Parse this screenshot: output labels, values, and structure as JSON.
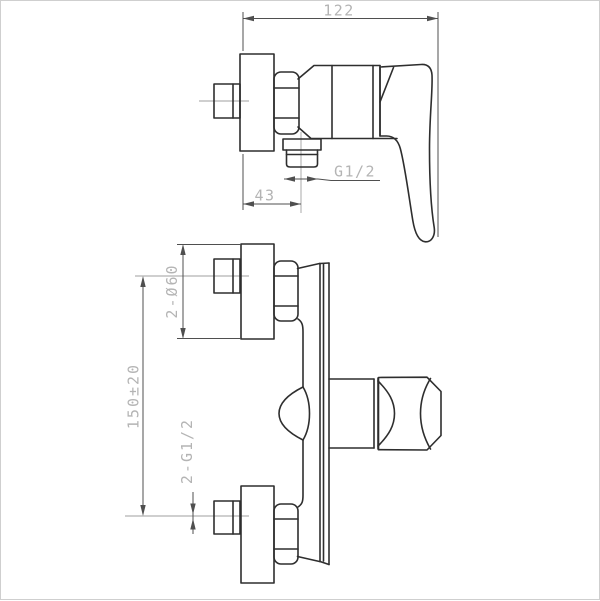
{
  "page": {
    "colors": {
      "background": "#ffffff",
      "border": "#cfcfcf",
      "line": "#2e2e2e",
      "thin": "#4f4f4f",
      "center": "#9f9f9f",
      "dimtext": "#b4b4b4"
    }
  },
  "side_view": {
    "dims": {
      "overall_width": "122",
      "outlet_offset": "43",
      "outlet_thread": "G1/2"
    }
  },
  "front_view": {
    "dims": {
      "flange_diameter": "2-Ø60",
      "inlet_spacing": "150±20",
      "inlet_thread": "2-G1/2"
    }
  }
}
